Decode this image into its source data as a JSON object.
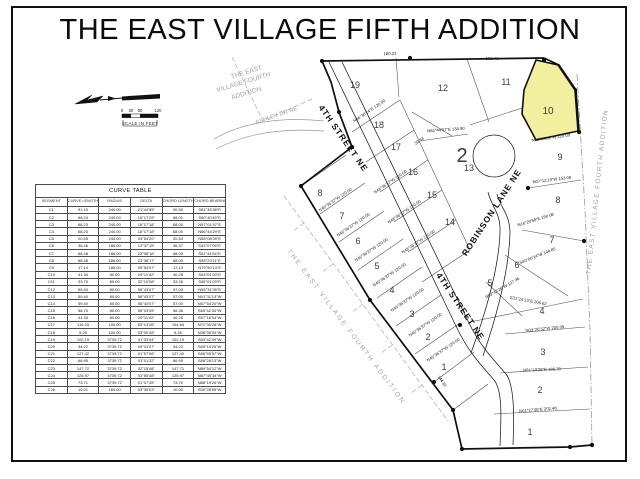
{
  "title": "THE EAST VILLAGE FIFTH ADDITION",
  "colors": {
    "highlight": "#f2ef9e",
    "line": "#1a1a1a",
    "faded": "#a0a0a0"
  },
  "scale_bar": {
    "ticks": [
      "0",
      "30",
      "60",
      "120"
    ],
    "label": "SCALE IN FEET"
  },
  "curve_table": {
    "title": "CURVE TABLE",
    "columns": [
      "SEGMENT",
      "CURVE LENGTH",
      "RADIUS",
      "DELTA",
      "CHORD LENGTH",
      "CHORD BEARING"
    ],
    "rows": [
      [
        "C1",
        "91.10",
        "240.00",
        "21°44'55\"",
        "90.55",
        "S81°35'38\"E"
      ],
      [
        "C2",
        "68.24",
        "240.00",
        "16°17'29\"",
        "68.01",
        "S80°40'49\"E"
      ],
      [
        "C3",
        "68.23",
        "240.00",
        "16°17'18\"",
        "68.00",
        "N57°01'47\"E"
      ],
      [
        "C4",
        "68.23",
        "240.00",
        "16°17'18\"",
        "68.00",
        "N66°44'29\"E"
      ],
      [
        "C5",
        "20.55",
        "240.00",
        "04°54'20\"",
        "20.54",
        "N58°08'39\"E"
      ],
      [
        "C6",
        "36.46",
        "186.00",
        "13°37'15\"",
        "36.37",
        "S43°07'09\"E"
      ],
      [
        "C7",
        "68.48",
        "186.00",
        "23°38'16\"",
        "68.00",
        "S61°44'54\"E"
      ],
      [
        "C8",
        "68.48",
        "186.00",
        "23°38'17\"",
        "68.00",
        "S85°23'11\"E"
      ],
      [
        "C9",
        "17.14",
        "186.00",
        "05°54'07\"",
        "17.13",
        "N79°50'13\"E"
      ],
      [
        "C10",
        "41.34",
        "80.00",
        "29°11'42\"",
        "40.25",
        "S63°01'20\"E"
      ],
      [
        "C11",
        "33.70",
        "80.00",
        "32°10'08\"",
        "33.26",
        "S85°01'03\"E"
      ],
      [
        "C12",
        "59.40",
        "80.00",
        "56°43'07\"",
        "57.00",
        "N55°31'35\"E"
      ],
      [
        "C13",
        "59.40",
        "80.00",
        "56°43'07\"",
        "57.00",
        "N01°11'13\"W"
      ],
      [
        "C14",
        "59.40",
        "80.00",
        "56°43'07\"",
        "57.00",
        "N57°54'20\"W"
      ],
      [
        "C15",
        "58.70",
        "80.00",
        "56°03'05\"",
        "56.36",
        "S65°42'34\"W"
      ],
      [
        "C16",
        "41.34",
        "80.00",
        "29°11'42\"",
        "40.25",
        "S57°16'54\"W"
      ],
      [
        "C17",
        "110.33",
        "100.00",
        "63°13'26\"",
        "104.84",
        "N71°30'26\"W"
      ],
      [
        "C18",
        "5.26",
        "100.00",
        "03°00'48\"",
        "5.26",
        "N38°06'04\"W"
      ],
      [
        "C19",
        "102.19",
        "3739.72",
        "01°33'54\"",
        "102.19",
        "S83°42'49\"W"
      ],
      [
        "C20",
        "34.22",
        "3739.72",
        "00°31'27\"",
        "34.22",
        "S85°14'25\"W"
      ],
      [
        "C21",
        "127.42",
        "3739.72",
        "01°57'08\"",
        "127.42",
        "S86°55'57\"W"
      ],
      [
        "C22",
        "66.95",
        "3739.72",
        "01°01'32\"",
        "66.95",
        "S88°28'13\"W"
      ],
      [
        "C23",
        "147.72",
        "3739.72",
        "02°15'48\"",
        "147.71",
        "N89°54'12\"W"
      ],
      [
        "C24",
        "125.97",
        "3739.72",
        "01°55'48\"",
        "125.97",
        "N87°45'34\"W"
      ],
      [
        "C25",
        "73.71",
        "3739.72",
        "01°07'45\"",
        "73.70",
        "N86°19'26\"W"
      ],
      [
        "C26",
        "10.01",
        "160.00",
        "03°35'03\"",
        "10.00",
        "S55°28'59\"W"
      ]
    ]
  },
  "plat": {
    "street_labels": [
      {
        "text": "4TH STREET NE",
        "x": 341,
        "y": 140,
        "rot": 55
      },
      {
        "text": "4TH STREET NE",
        "x": 458,
        "y": 308,
        "rot": 56
      },
      {
        "text": "ROBINSON LANE NE",
        "x": 494,
        "y": 214,
        "rot": -57
      }
    ],
    "lot_numbers": [
      {
        "text": "19",
        "x": 355,
        "y": 88
      },
      {
        "text": "18",
        "x": 379,
        "y": 128
      },
      {
        "text": "17",
        "x": 396,
        "y": 150
      },
      {
        "text": "16",
        "x": 413,
        "y": 175
      },
      {
        "text": "15",
        "x": 432,
        "y": 198
      },
      {
        "text": "14",
        "x": 450,
        "y": 225
      },
      {
        "text": "13",
        "x": 469,
        "y": 171
      },
      {
        "text": "12",
        "x": 443,
        "y": 91
      },
      {
        "text": "11",
        "x": 506,
        "y": 85
      },
      {
        "text": "10",
        "x": 548,
        "y": 114,
        "size": 10
      },
      {
        "text": "9",
        "x": 560,
        "y": 160
      },
      {
        "text": "8",
        "x": 558,
        "y": 203
      },
      {
        "text": "7",
        "x": 552,
        "y": 243
      },
      {
        "text": "6",
        "x": 517,
        "y": 268
      },
      {
        "text": "5",
        "x": 490,
        "y": 286
      },
      {
        "text": "4",
        "x": 542,
        "y": 314
      },
      {
        "text": "3",
        "x": 543,
        "y": 355
      },
      {
        "text": "2",
        "x": 540,
        "y": 393
      },
      {
        "text": "1",
        "x": 530,
        "y": 435
      },
      {
        "text": "8",
        "x": 320,
        "y": 196
      },
      {
        "text": "7",
        "x": 342,
        "y": 219
      },
      {
        "text": "6",
        "x": 358,
        "y": 244
      },
      {
        "text": "5",
        "x": 377,
        "y": 269
      },
      {
        "text": "4",
        "x": 392,
        "y": 293
      },
      {
        "text": "3",
        "x": 412,
        "y": 317
      },
      {
        "text": "2",
        "x": 428,
        "y": 340
      },
      {
        "text": "1",
        "x": 444,
        "y": 370
      },
      {
        "text": "2",
        "x": 462,
        "y": 162,
        "size": 20
      }
    ],
    "bearing_labels": [
      {
        "text": "180.23",
        "x": 390,
        "y": 55,
        "rot": -1
      },
      {
        "text": "188.40",
        "x": 492,
        "y": 60,
        "rot": 2
      },
      {
        "text": "N62°44'07\"E  134.90",
        "x": 446,
        "y": 131,
        "rot": -4
      },
      {
        "text": "N08°06'32\"W  120.00",
        "x": 551,
        "y": 139,
        "rot": -8
      },
      {
        "text": "N07°12'19\"W  153.08",
        "x": 552,
        "y": 181,
        "rot": -7
      },
      {
        "text": "N16°20'58\"E  150.08",
        "x": 536,
        "y": 221,
        "rot": -17
      },
      {
        "text": "S40°06'14\"W  144.85",
        "x": 538,
        "y": 257,
        "rot": -22
      },
      {
        "text": "S53°42'26\"W  127.36",
        "x": 503,
        "y": 289,
        "rot": -30
      },
      {
        "text": "S31°24'13\"E  206.62",
        "x": 528,
        "y": 302,
        "rot": 10
      },
      {
        "text": "N03°26'32\"W  205.05",
        "x": 545,
        "y": 330,
        "rot": -6
      },
      {
        "text": "N01°10'26\"E  186.78",
        "x": 542,
        "y": 371,
        "rot": -2
      },
      {
        "text": "N01°27'35\"E  202.48",
        "x": 538,
        "y": 411,
        "rot": -5
      },
      {
        "text": "144.82",
        "x": 441,
        "y": 382,
        "rot": 56
      },
      {
        "text": "29.53",
        "x": 420,
        "y": 142,
        "rot": -35
      },
      {
        "text": "N46°36'37\"W  120.00",
        "x": 336,
        "y": 201,
        "rot": -34
      },
      {
        "text": "N46°36'37\"W  120.00",
        "x": 354,
        "y": 226,
        "rot": -34
      },
      {
        "text": "N46°36'37\"W  120.00",
        "x": 372,
        "y": 251,
        "rot": -34
      },
      {
        "text": "N46°36'37\"W  120.00",
        "x": 390,
        "y": 276,
        "rot": -34
      },
      {
        "text": "N46°36'37\"W  120.00",
        "x": 408,
        "y": 301,
        "rot": -34
      },
      {
        "text": "N46°36'37\"W  120.00",
        "x": 426,
        "y": 326,
        "rot": -34
      },
      {
        "text": "N46°36'37\"W  120.00",
        "x": 444,
        "y": 351,
        "rot": -34
      },
      {
        "text": "N48°36'37\"W  120.00",
        "x": 391,
        "y": 183,
        "rot": -34
      },
      {
        "text": "N48°36'37\"W  120.00",
        "x": 405,
        "y": 213,
        "rot": -34
      },
      {
        "text": "N48°36'37\"W  120.00",
        "x": 419,
        "y": 243,
        "rot": -34
      },
      {
        "text": "N46°36'24\"E  120.00",
        "x": 370,
        "y": 112,
        "rot": -34
      }
    ],
    "faded_labels": [
      {
        "text": "THE EAST",
        "x": 247,
        "y": 74,
        "rot": -17,
        "size": 6.5
      },
      {
        "text": "VILLAGE FOURTH",
        "x": 244,
        "y": 84,
        "rot": -17,
        "size": 6.5
      },
      {
        "text": "ADDITION",
        "x": 247,
        "y": 95,
        "rot": -17,
        "size": 6.5
      },
      {
        "text": "ASHLEY DR NE",
        "x": 277,
        "y": 117,
        "rot": -19,
        "size": 6
      },
      {
        "text": "THE EAST VILLAGE FOURTH ADDITION",
        "x": 345,
        "y": 328,
        "rot": 53,
        "size": 6.5,
        "ls": 2.2
      },
      {
        "text": "THE EAST VILLAGE FOURTH ADDITION",
        "x": 599,
        "y": 192,
        "rot": -84,
        "size": 6.5,
        "ls": 1.4
      }
    ]
  }
}
